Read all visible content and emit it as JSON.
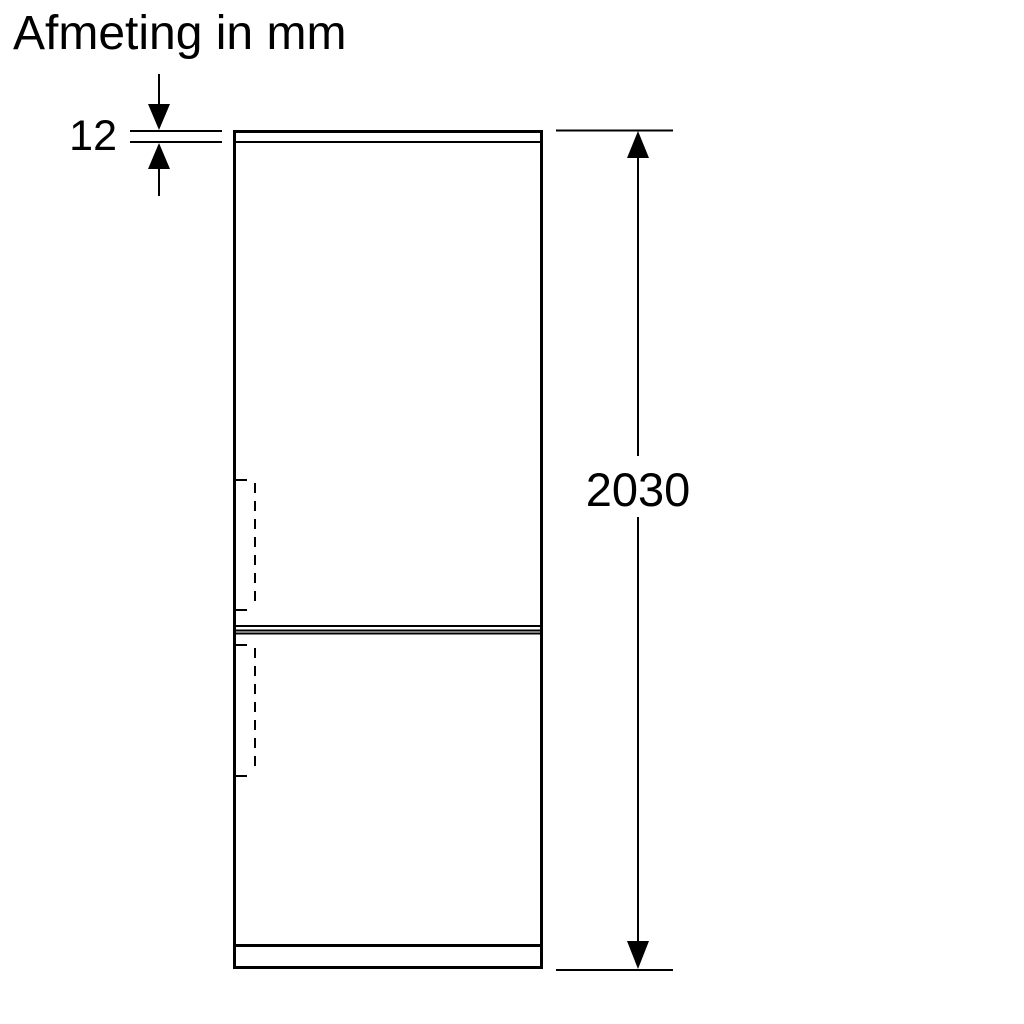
{
  "title": "Afmeting in mm",
  "diagram": {
    "type": "product-dimension-drawing",
    "subject": "fridge-freezer front outline",
    "labels": {
      "panel_thickness_mm": "12",
      "total_height_mm": "2030"
    }
  },
  "colors": {
    "background": "#ffffff",
    "line": "#000000",
    "text": "#000000"
  }
}
